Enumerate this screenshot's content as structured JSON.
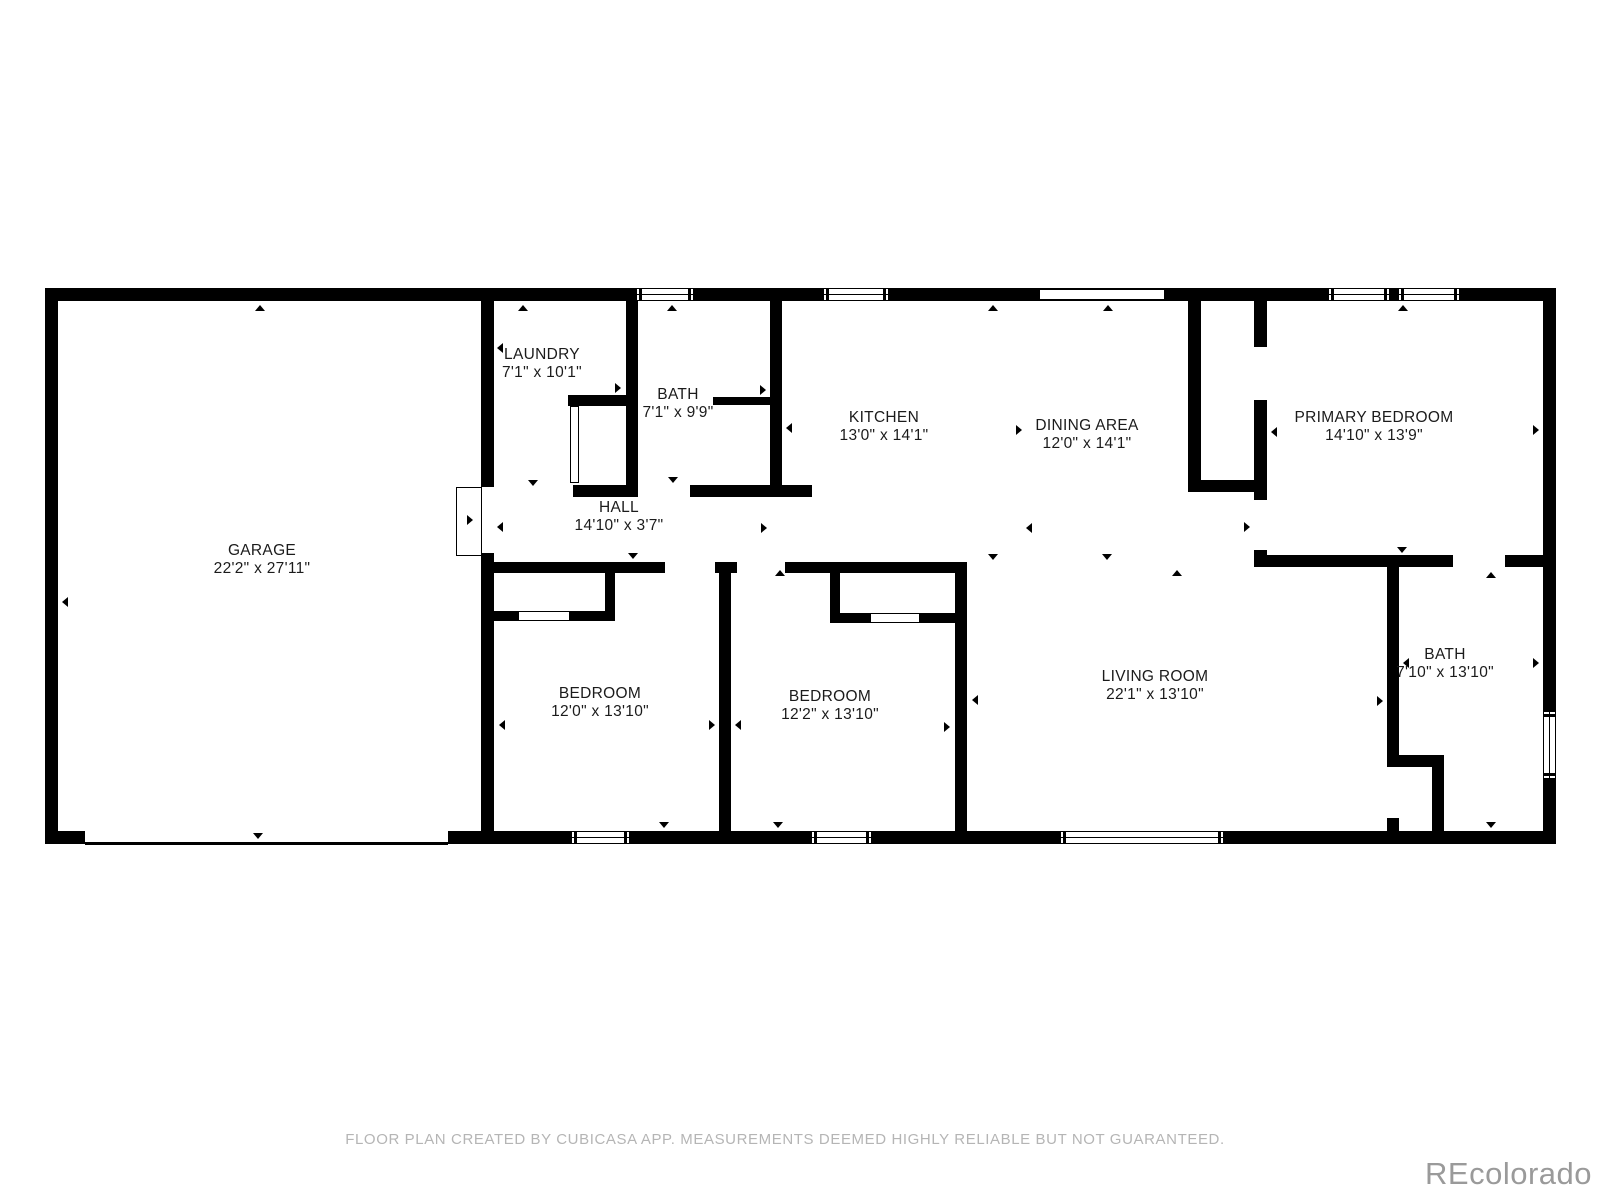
{
  "footer": {
    "disclaimer": "FLOOR PLAN CREATED BY CUBICASA APP. MEASUREMENTS DEEMED HIGHLY RELIABLE BUT NOT GUARANTEED."
  },
  "watermark": "REcolorado",
  "colors": {
    "wall": "#000000",
    "background": "#ffffff",
    "label_text": "#1b1b1b",
    "footer_text": "#b5b5b5",
    "watermark_text": "#9a9a9a"
  },
  "rooms": [
    {
      "name": "GARAGE",
      "dims": "22'2\" x 27'11\"",
      "x": 262,
      "y": 560
    },
    {
      "name": "LAUNDRY",
      "dims": "7'1\" x 10'1\"",
      "x": 542,
      "y": 364
    },
    {
      "name": "BATH",
      "dims": "7'1\" x 9'9\"",
      "x": 678,
      "y": 404
    },
    {
      "name": "KITCHEN",
      "dims": "13'0\" x 14'1\"",
      "x": 884,
      "y": 427
    },
    {
      "name": "DINING AREA",
      "dims": "12'0\" x 14'1\"",
      "x": 1087,
      "y": 435
    },
    {
      "name": "PRIMARY BEDROOM",
      "dims": "14'10\" x 13'9\"",
      "x": 1374,
      "y": 427
    },
    {
      "name": "HALL",
      "dims": "14'10\" x 3'7\"",
      "x": 619,
      "y": 517
    },
    {
      "name": "BEDROOM",
      "dims": "12'0\" x 13'10\"",
      "x": 600,
      "y": 703
    },
    {
      "name": "BEDROOM",
      "dims": "12'2\" x 13'10\"",
      "x": 830,
      "y": 706
    },
    {
      "name": "LIVING ROOM",
      "dims": "22'1\" x 13'10\"",
      "x": 1155,
      "y": 686
    },
    {
      "name": "BATH",
      "dims": "7'10\" x 13'10\"",
      "x": 1445,
      "y": 664
    }
  ],
  "plan": {
    "walls": [
      [
        45,
        288,
        1511,
        13
      ],
      [
        45,
        831,
        1511,
        13
      ],
      [
        45,
        288,
        13,
        556
      ],
      [
        1543,
        288,
        13,
        556
      ],
      [
        481,
        301,
        13,
        186
      ],
      [
        481,
        553,
        13,
        278
      ],
      [
        626,
        301,
        12,
        196
      ],
      [
        568,
        395,
        70,
        11
      ],
      [
        573,
        485,
        65,
        12
      ],
      [
        690,
        485,
        122,
        12
      ],
      [
        770,
        301,
        12,
        196
      ],
      [
        713,
        397,
        57,
        8
      ],
      [
        481,
        562,
        184,
        11
      ],
      [
        715,
        562,
        22,
        11
      ],
      [
        785,
        562,
        182,
        11
      ],
      [
        719,
        573,
        12,
        258
      ],
      [
        955,
        562,
        12,
        269
      ],
      [
        605,
        573,
        10,
        48
      ],
      [
        494,
        611,
        24,
        10
      ],
      [
        570,
        611,
        45,
        10
      ],
      [
        830,
        573,
        10,
        50
      ],
      [
        840,
        613,
        30,
        10
      ],
      [
        920,
        613,
        35,
        10
      ],
      [
        1188,
        301,
        13,
        191
      ],
      [
        1188,
        480,
        79,
        12
      ],
      [
        1254,
        301,
        13,
        46
      ],
      [
        1254,
        400,
        13,
        100
      ],
      [
        1254,
        550,
        13,
        17
      ],
      [
        1254,
        555,
        199,
        12
      ],
      [
        1505,
        555,
        38,
        12
      ],
      [
        1387,
        567,
        12,
        200
      ],
      [
        1387,
        818,
        12,
        13
      ],
      [
        1387,
        755,
        57,
        12
      ],
      [
        1432,
        767,
        12,
        64
      ]
    ],
    "garage_door": {
      "gap": [
        85,
        830,
        363,
        12
      ],
      "line": [
        85,
        842,
        363,
        2.5
      ]
    },
    "windows": [
      [
        636,
        288,
        58,
        13,
        "h"
      ],
      [
        823,
        288,
        66,
        13,
        "h"
      ],
      [
        1039,
        289,
        126,
        11,
        "plain"
      ],
      [
        1328,
        288,
        62,
        13,
        "h"
      ],
      [
        1398,
        288,
        62,
        13,
        "h"
      ],
      [
        571,
        831,
        59,
        13,
        "h"
      ],
      [
        811,
        831,
        61,
        13,
        "h"
      ],
      [
        1060,
        831,
        164,
        13,
        "h"
      ],
      [
        1543,
        711,
        13,
        68,
        "v"
      ]
    ],
    "door_leaves": [
      [
        456,
        487,
        26,
        69
      ],
      [
        570,
        406,
        9,
        77
      ],
      [
        518,
        611,
        52,
        10
      ],
      [
        870,
        613,
        50,
        10
      ]
    ],
    "ticks": {
      "up": [
        [
          260,
          305
        ],
        [
          523,
          305
        ],
        [
          672,
          305
        ],
        [
          993,
          305
        ],
        [
          1108,
          305
        ],
        [
          1403,
          305
        ],
        [
          780,
          570
        ],
        [
          1177,
          570
        ],
        [
          1491,
          572
        ]
      ],
      "down": [
        [
          258,
          839
        ],
        [
          533,
          486
        ],
        [
          633,
          559
        ],
        [
          673,
          483
        ],
        [
          664,
          828
        ],
        [
          778,
          828
        ],
        [
          993,
          560
        ],
        [
          1107,
          560
        ],
        [
          1402,
          553
        ],
        [
          1491,
          828
        ]
      ],
      "left": [
        [
          62,
          602
        ],
        [
          497,
          348
        ],
        [
          497,
          527
        ],
        [
          499,
          725
        ],
        [
          735,
          725
        ],
        [
          786,
          428
        ],
        [
          972,
          700
        ],
        [
          1026,
          528
        ],
        [
          1271,
          432
        ],
        [
          1403,
          663
        ]
      ],
      "right": [
        [
          473,
          520
        ],
        [
          621,
          388
        ],
        [
          715,
          725
        ],
        [
          766,
          390
        ],
        [
          767,
          528
        ],
        [
          950,
          727
        ],
        [
          1022,
          430
        ],
        [
          1250,
          527
        ],
        [
          1383,
          701
        ],
        [
          1539,
          430
        ],
        [
          1539,
          663
        ]
      ]
    }
  }
}
